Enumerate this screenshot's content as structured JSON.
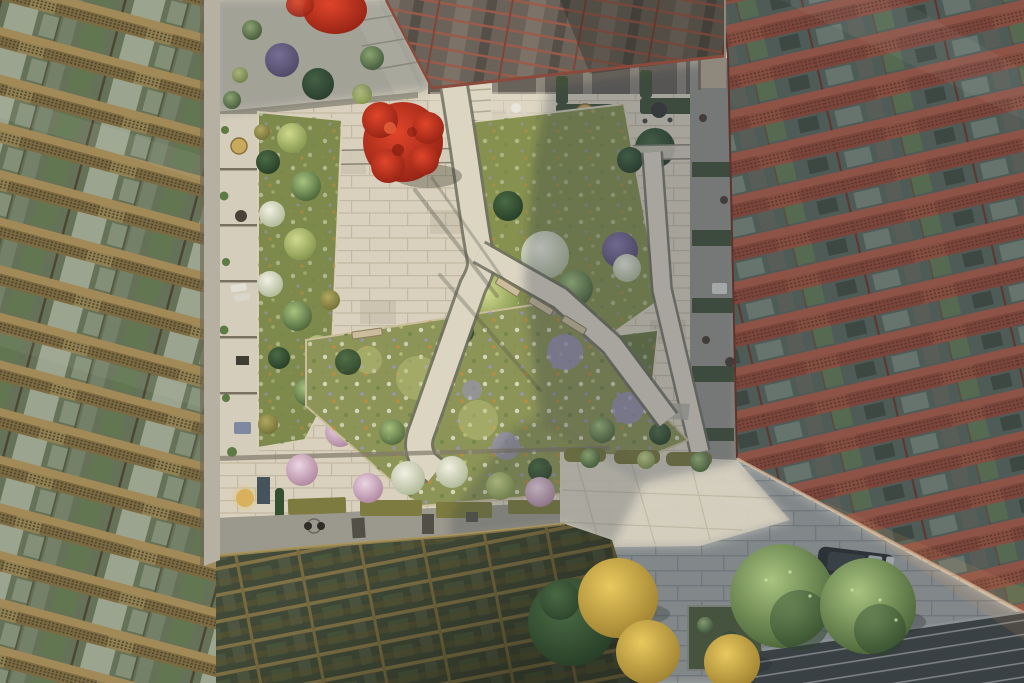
{
  "scene": {
    "description": "Aerial view straight down into a residential courtyard garden: bronze-lattice apartment facade on the left, terracotta-lattice facade on the right, a red-framed entrance canopy at the top and a bronze glazed roof canopy at the bottom; limestone paths wind between planted beds with a red maple, pink and white blossom trees, a wildflower meadow, benches and ground-floor terraces; a shaded street plaza with green and golden trees, a parked car and pedestrians sits at the lower right.",
    "elements": [
      "left-building-facade",
      "right-building-facade",
      "top-entrance-canopy",
      "gold-roof-canopy",
      "dark-glass-canopy",
      "courtyard-paving",
      "central-meadow",
      "red-maple-tree",
      "blossom-trees",
      "garden-benches",
      "terrace-furniture",
      "street-plaza",
      "parked-car",
      "pedestrians",
      "street-trees"
    ]
  },
  "palette": {
    "paving_sun": "#d9d1bd",
    "tile_dark": "#8f8670",
    "plaza_shade": "#a7aaa6",
    "plaza_sun": "#d8d1c0",
    "terrace_pale": "#c6c1b1",
    "walk_gray": "#9b988d",
    "path_light": "#dcd5c2",
    "path_curb": "#6f6e60",
    "facade_gold_slab": "#a18a58",
    "facade_gold_lattice": "#7c6a40",
    "facade_gold_glass": "#667257",
    "facade_gold_dark": "#4a4230",
    "facade_red_slab": "#8d5346",
    "facade_red_lattice": "#7a463c",
    "facade_red_glass": "#4f5b57",
    "facade_red_dark": "#5e342c",
    "canopy_beam": "#93824f",
    "canopy_glass": "#49523f",
    "dark_canopy_glass": "#3a4144",
    "dark_canopy_frame": "#8a9094",
    "concrete_pier": "#b5b0a2",
    "hedge_olive": "#7d7b3f",
    "hedge_dark": "#44533a",
    "meadow_base": "#8d9457",
    "meadow_purple": "#9c93c6",
    "shadow_tint": "#2e3a46",
    "bench_wood": "#cbbd9b",
    "furn_tan": "#c8a95e",
    "car_body": "#2c3132",
    "person_dark": "#26261f",
    "tree_green_hi": "#a8c37f",
    "tree_green_lo": "#435c33",
    "tree_dark_hi": "#4a6b44",
    "tree_dark_lo": "#253a25",
    "tree_lime_hi": "#d0d98d",
    "tree_lime_lo": "#7d9048",
    "bloom_white_hi": "#f2f0e2",
    "bloom_white_lo": "#a9b491",
    "bloom_pink_hi": "#ecd5e2",
    "bloom_pink_lo": "#a97f99",
    "tree_purple_hi": "#8d7fae",
    "tree_purple_lo": "#55496b",
    "tree_red_hi": "#e0452a",
    "tree_red_lo": "#8c1f12",
    "tree_yellow_hi": "#e8c95e",
    "tree_yellow_lo": "#9a7c2e",
    "tree_olive_hi": "#b0a860",
    "tree_olive_lo": "#6f6c34"
  }
}
